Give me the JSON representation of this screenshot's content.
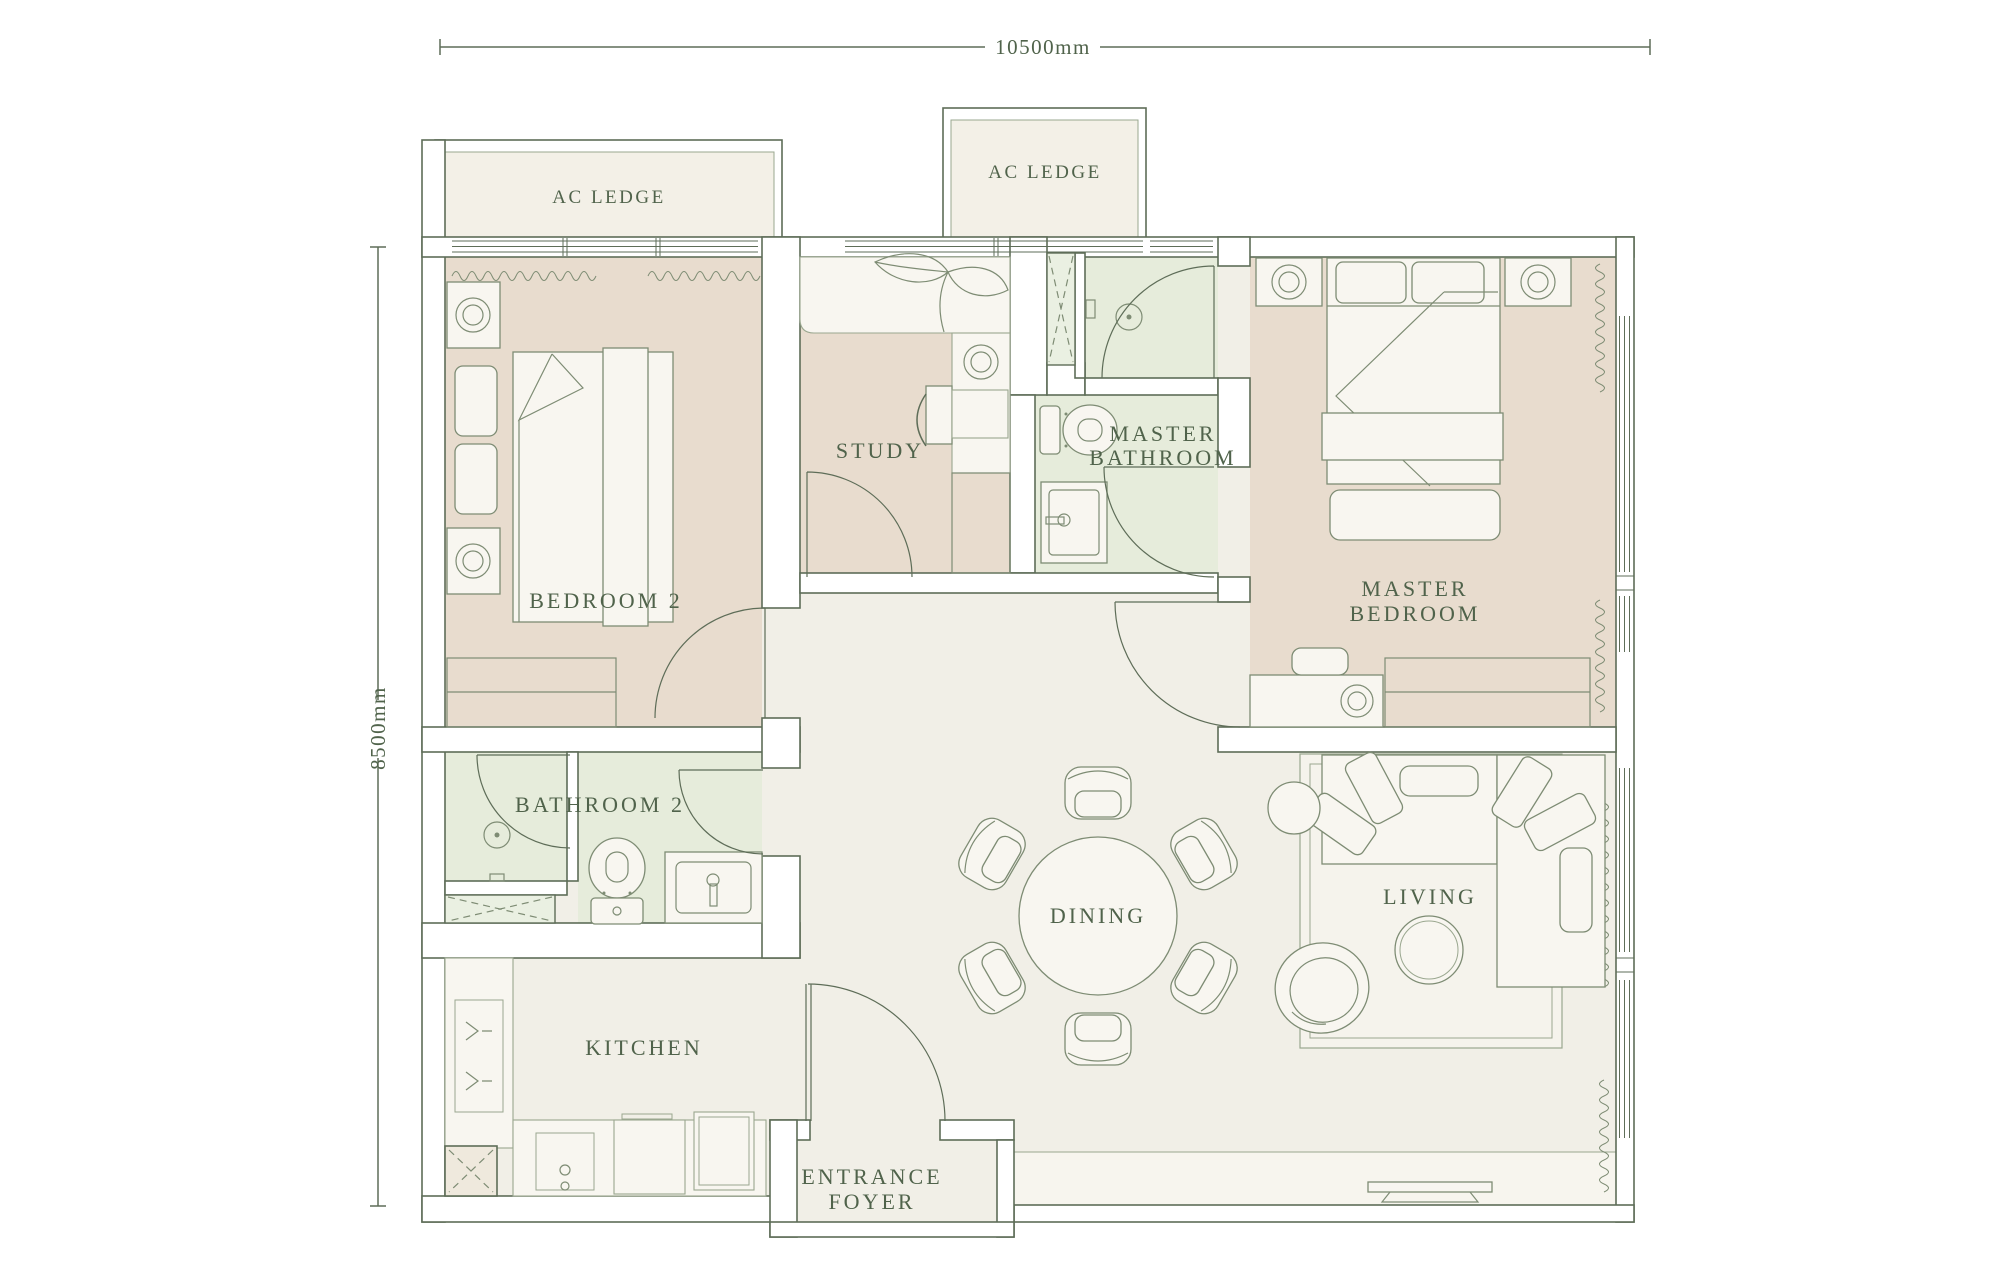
{
  "palette": {
    "bg": "#ffffff",
    "line": "#5e6d58",
    "line-soft": "#9aa78f",
    "text": "#50634b",
    "floor": "#f1efe7",
    "tan": "#e8dcce",
    "green": "#e6ecdb",
    "ac": "#f3f0e7",
    "furn": "#f8f6f0",
    "furn-line": "#7e8c74",
    "rug": "#f5f3ec",
    "bay": "#f7f5ee",
    "hatch": "#8a9880",
    "shaft": "#efe9dd",
    "shaft-green": "#eaf0e2"
  },
  "dimensions": {
    "top": "10500mm",
    "left": "8500mm"
  },
  "rooms": {
    "ac_ledge_left": {
      "label": "AC LEDGE"
    },
    "ac_ledge_mid": {
      "label": "AC LEDGE"
    },
    "bedroom2": {
      "label": "BEDROOM 2"
    },
    "study": {
      "label": "STUDY"
    },
    "master_bathroom": {
      "lines": [
        "MASTER",
        "BATHROOM"
      ]
    },
    "master_bedroom": {
      "lines": [
        "MASTER",
        "BEDROOM"
      ]
    },
    "bathroom2": {
      "label": "BATHROOM 2"
    },
    "dining": {
      "label": "DINING"
    },
    "living": {
      "label": "LIVING"
    },
    "kitchen": {
      "label": "KITCHEN"
    },
    "entrance_foyer": {
      "lines": [
        "ENTRANCE",
        "FOYER"
      ]
    }
  }
}
